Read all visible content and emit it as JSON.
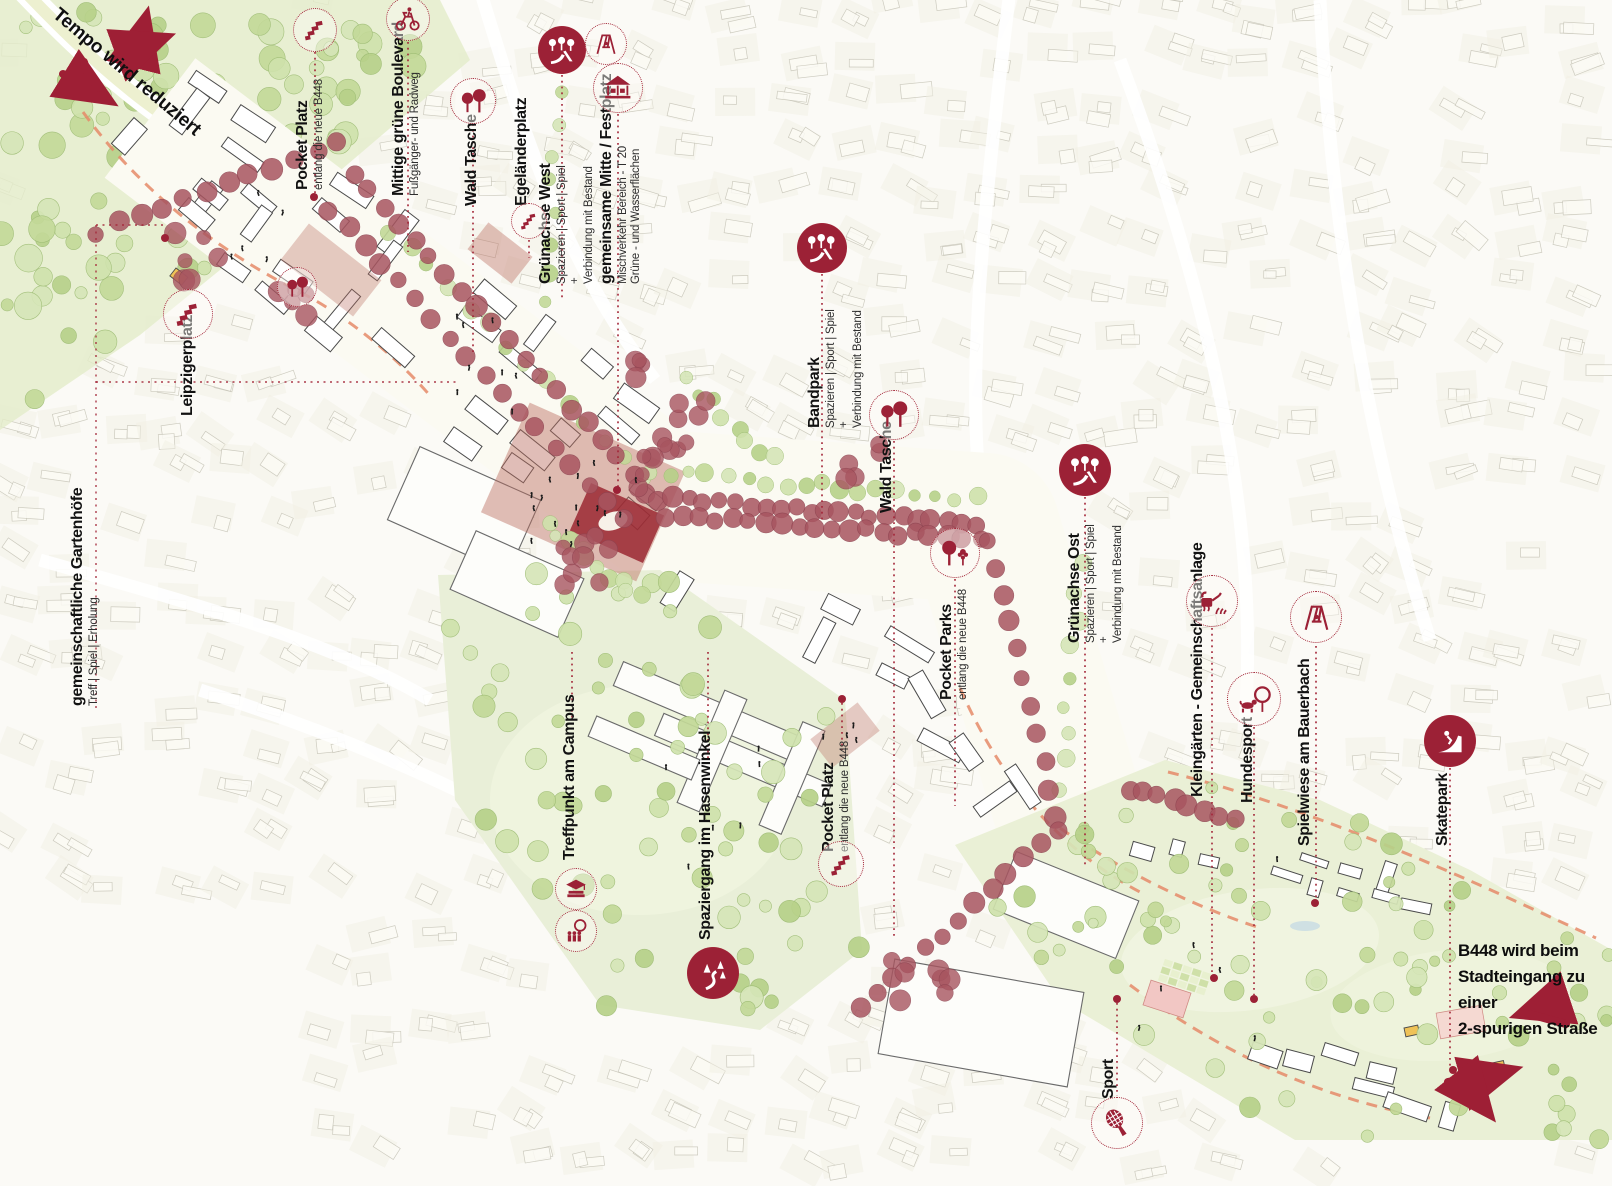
{
  "colors": {
    "accent_red": "#9c2136",
    "tree_red": "#a85560",
    "salmon_dash": "#e58a68",
    "green_light": "#cfe2ac",
    "plaza_red": "#bb6c60",
    "arrow_red": "#9e1f35"
  },
  "notes": {
    "tempo": "Tempo wird reduziert",
    "b448_lines": [
      "B448 wird beim",
      "Stadteingang zu einer",
      "2-spurigen Straße"
    ]
  },
  "annotations": {
    "pocket_platz_nw": {
      "title": "Pocket Platz",
      "subtitles": [
        "entlang die neue B448"
      ],
      "icon": "steps-icon"
    },
    "mittige_boulevard": {
      "title": "Mittige grüne Boulevard",
      "subtitles": [
        "Fußgänger- und Radweg"
      ],
      "icon": "bicycle-icon"
    },
    "wald_tasche_nw": {
      "title": "Wald Tasche",
      "icon": "trees-icon"
    },
    "egelaenderplatz": {
      "title": "Egeländerplatz",
      "icon": "steps-icon"
    },
    "gruenachse_west": {
      "title": "Grünachse West",
      "subtitles": [
        "Spazieren | Sport | Spiel",
        "+",
        "Verbindung mit Bestand"
      ],
      "icons": [
        "playground-icon",
        "swing-icon"
      ]
    },
    "gemeinsame_mitte": {
      "title": "gemeinsame Mitte / Festplatz",
      "subtitles": [
        "Mischverkehr Bereich - T 20",
        "Grüne - und Wasserflächen"
      ],
      "icon": "carousel-icon"
    },
    "bandpark": {
      "title": "Bandpark",
      "subtitles": [
        "Spazieren | Sport | Spiel",
        "+",
        "Verbindung mit Bestand"
      ],
      "icon": "playground-icon"
    },
    "wald_tasche_e": {
      "title": "Wald Tasche",
      "icon": "trees-icon"
    },
    "pocket_parks": {
      "title": "Pocket Parks",
      "subtitles": [
        "entlang die neue B448"
      ],
      "icon": "park-trees-icon"
    },
    "treffpunkt_campus": {
      "title": "Treffpunkt am Campus",
      "icons": [
        "education-icon",
        "meeting-icon"
      ]
    },
    "hasenwinkel": {
      "title": "Spaziergang im Hasenwinkel",
      "icon": "forest-walk-icon"
    },
    "pocket_platz_s": {
      "title": "Pocket Platz",
      "subtitles": [
        "entlang die neue B448"
      ],
      "icon": "steps-icon"
    },
    "gruenachse_ost": {
      "title": "Grünachse Ost",
      "subtitles": [
        "Spazieren | Sport | Spiel",
        "+",
        "Verbindung mit Bestand"
      ],
      "icon": "playground-icon"
    },
    "kleingaerten": {
      "title": "Kleingärten - Gemeinschaftsanlage",
      "icon": "garden-icon"
    },
    "hundesport": {
      "title": "Hundesport",
      "icon": "dog-agility-icon"
    },
    "spielwiese": {
      "title": "Spielwiese am Bauerbach",
      "icon": "swing-icon"
    },
    "skatepark": {
      "title": "Skatepark",
      "icon": "skate-icon"
    },
    "sport": {
      "title": "Sport",
      "icon": "racket-icon"
    },
    "leipzigerplatz": {
      "title": "Leipzigerplatz",
      "icon": "steps-icon"
    },
    "gartenhoefe": {
      "title": "gemeinschaftliche Gartenhöfe",
      "subtitles": [
        "Treff | Spiel | Erholung"
      ]
    }
  },
  "map_markers": {
    "wald_tasche_spot": {
      "icon": "trees-icon"
    }
  }
}
